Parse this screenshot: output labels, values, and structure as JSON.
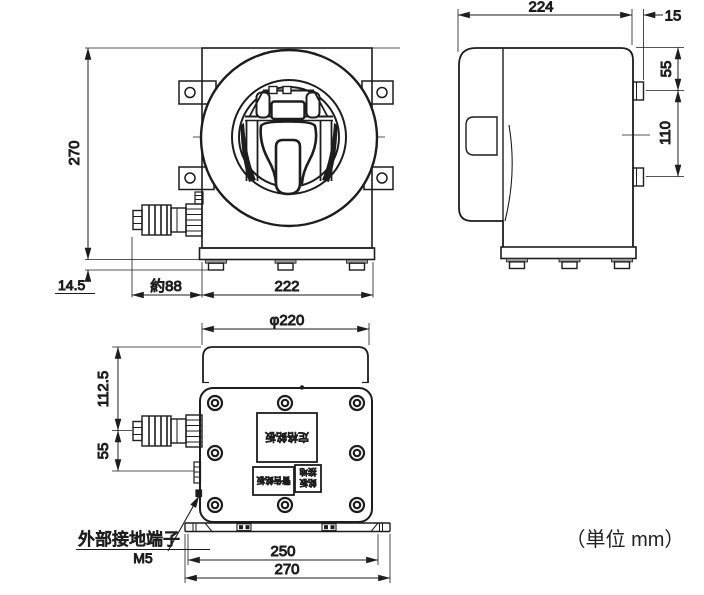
{
  "drawing": {
    "unit_note": "（単位 mm）",
    "front_view": {
      "dim_height": "270",
      "dim_foot_height": "14.5",
      "dim_connector_length": "約88",
      "dim_body_width": "222"
    },
    "side_view": {
      "dim_depth": "224",
      "dim_tab_protrusion": "15",
      "dim_tab_offset_top": "55",
      "dim_tab_pitch": "110"
    },
    "bottom_view": {
      "dim_bezel_diameter": "φ220",
      "dim_connector_offset": "112.5",
      "dim_ground_offset": "55",
      "dim_base_hole_pitch": "250",
      "dim_base_width": "270",
      "ground_terminal_label": "外部接地端子",
      "ground_terminal_size": "M5",
      "nameplate_main": "定格銘板",
      "nameplate_warning": "警告銘板",
      "nameplate_small_line1": "接地",
      "nameplate_small_line2": "銘板"
    }
  }
}
